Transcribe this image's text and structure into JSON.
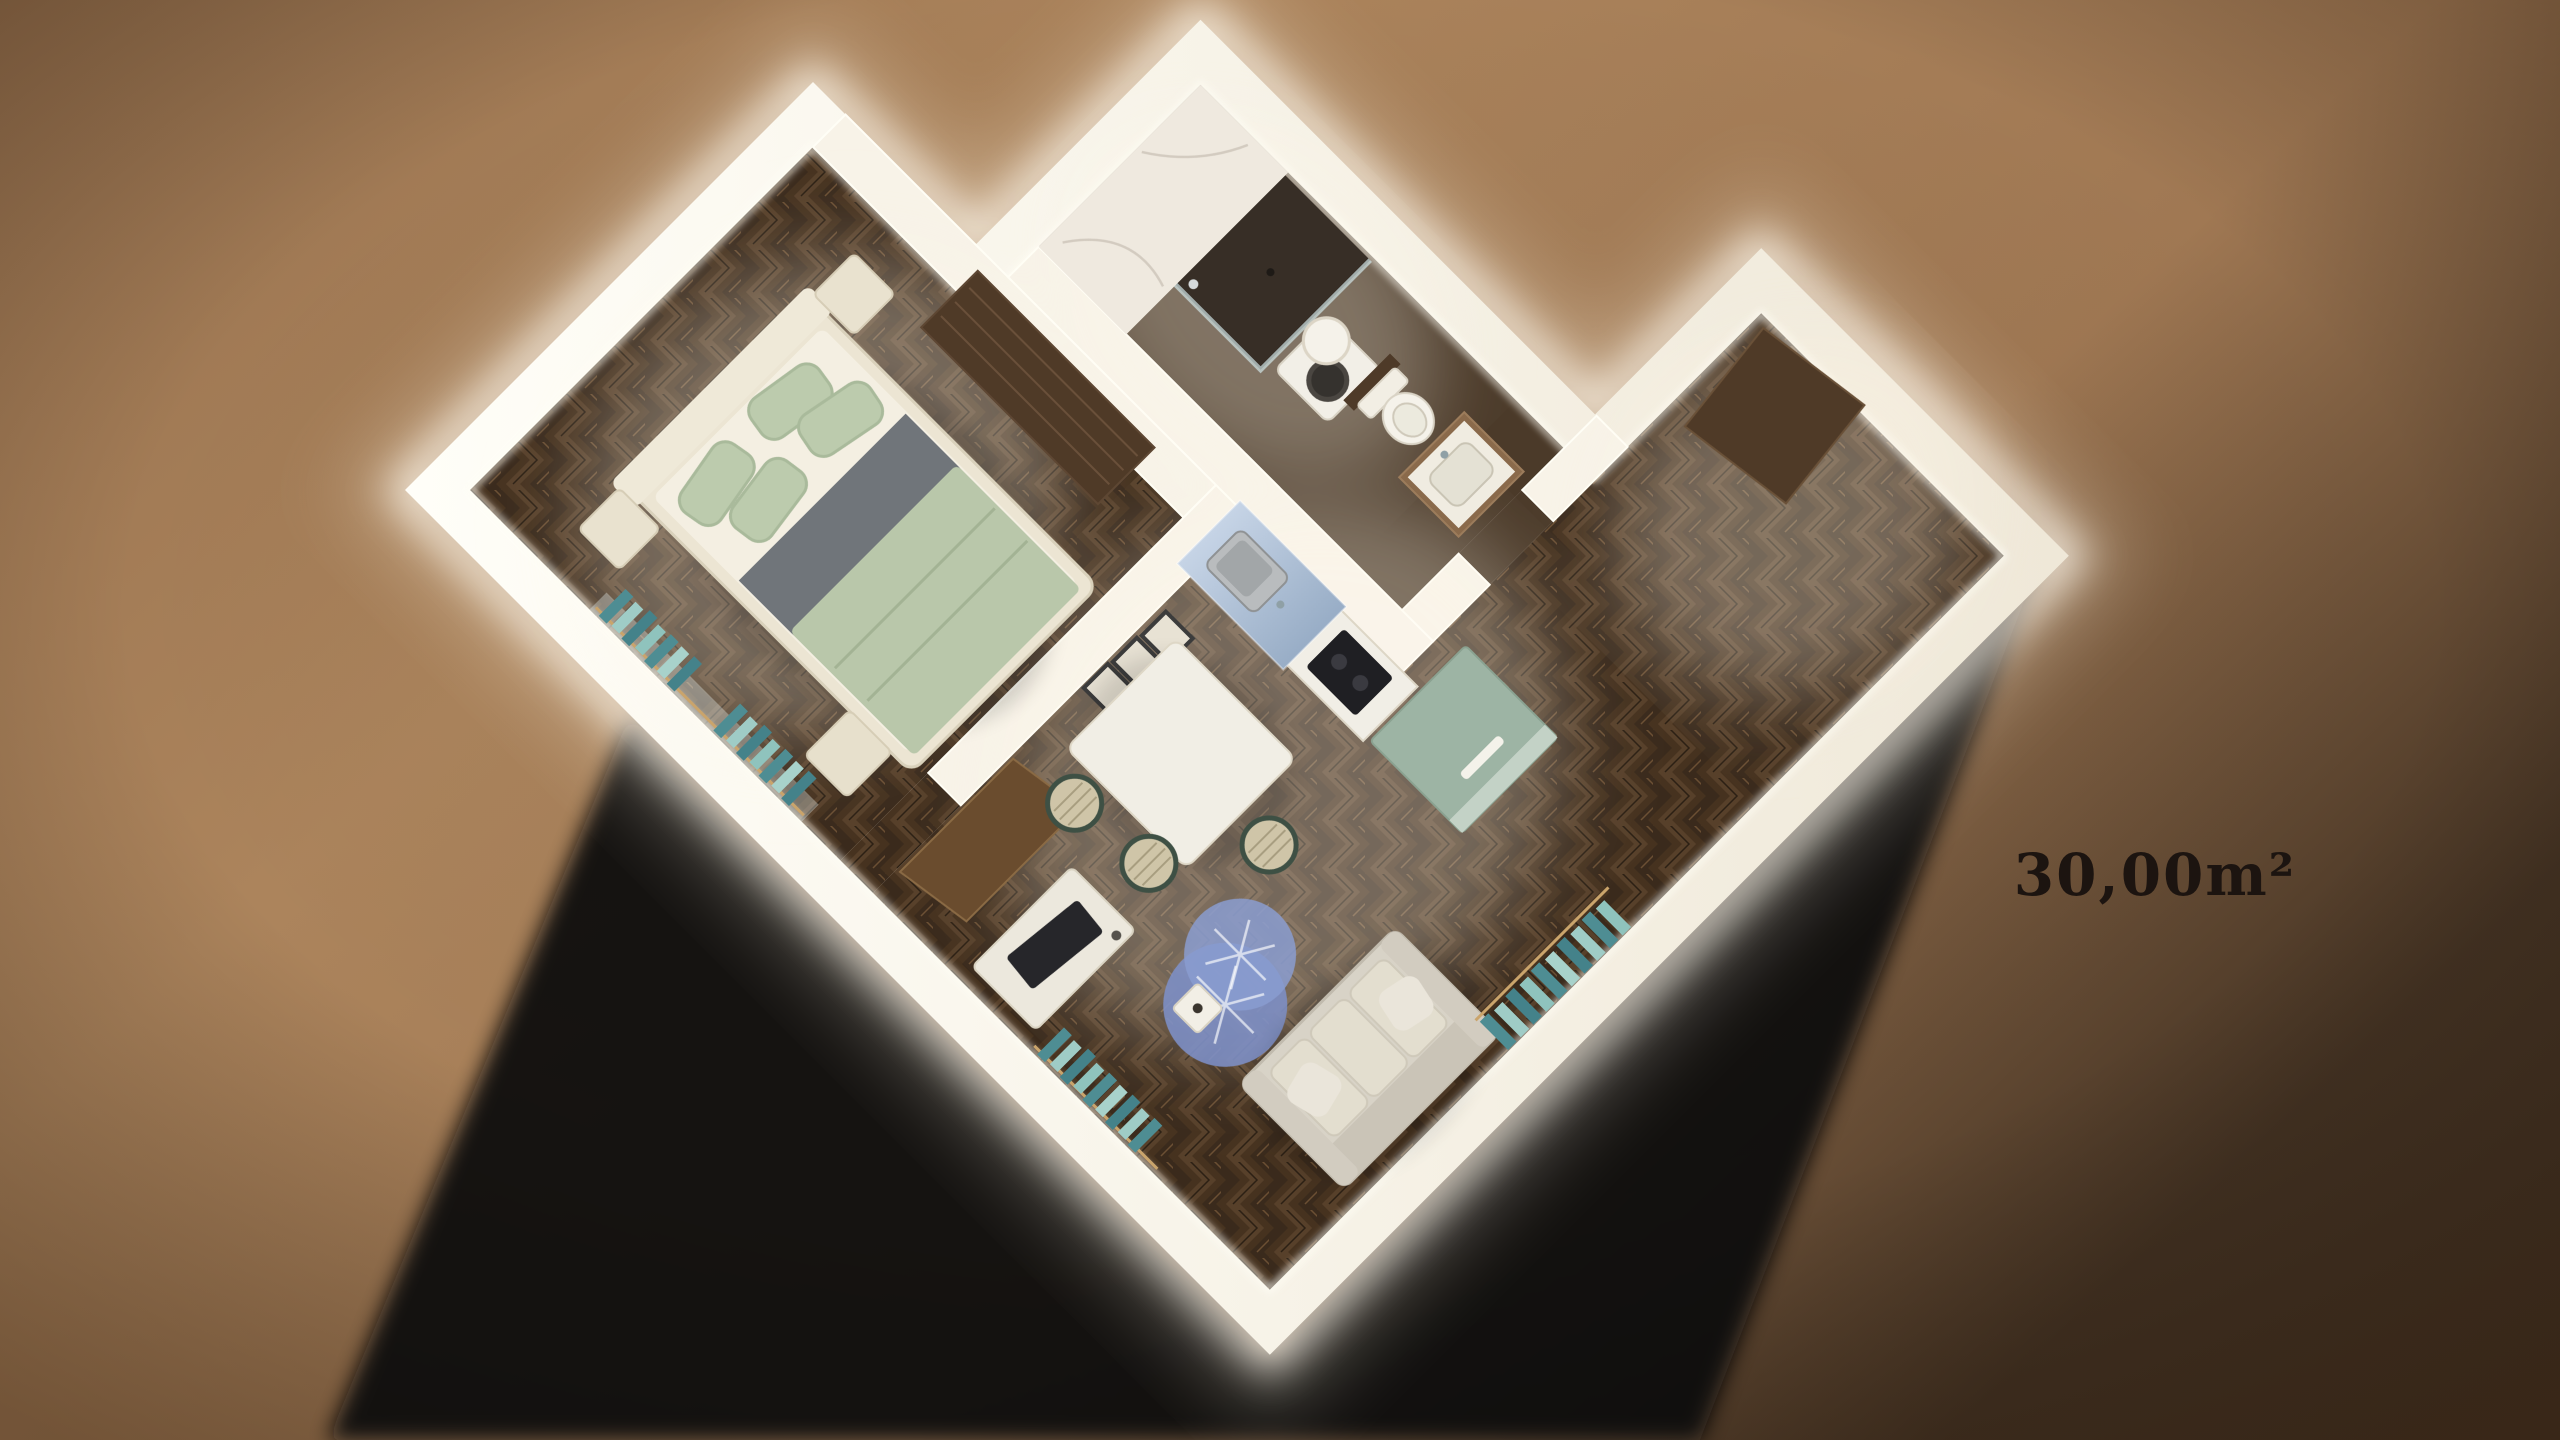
{
  "page": {
    "title": "3D apartment floor plan render"
  },
  "label": {
    "area": "30,00m²"
  },
  "colors": {
    "background_light": "#b0885f",
    "background_dark": "#8a6747",
    "shadow": "#0a0a11",
    "wall": "#f8f3e8",
    "wall_glow": "#fffdf2",
    "floor_wood": "#46321f",
    "floor_bath": "#4b3a29",
    "marble": "#efe9df",
    "teal_curtain": "#4e8d93",
    "sage_bedding": "#b9c7aa",
    "gray_sheet": "#70757a",
    "rug_blue": "#7d90c7",
    "counter_glass_blue": "#b6c6da",
    "cabinet_green": "#9db4a4",
    "wood_dark": "#4f3a27",
    "sofa_gray": "#d8d3c7",
    "text": "#1c1410"
  },
  "scene": {
    "view": "isometric-top-down-render",
    "rooms": [
      {
        "name": "bedroom",
        "furniture": [
          "double-bed",
          "sage-pillows",
          "nightstand",
          "nightstand",
          "foot-ottoman",
          "dark-wardrobe",
          "teal-curtains"
        ]
      },
      {
        "name": "bathroom",
        "furniture": [
          "walk-in-shower",
          "washing-machine",
          "water-heater-cylinder",
          "toilet",
          "wood-vanity",
          "marble-wall"
        ]
      },
      {
        "name": "living-kitchen",
        "furniture": [
          "kitchen-counter",
          "sink",
          "cooktop",
          "blue-glass-panel",
          "green-cabinet",
          "dining-table",
          "woven-stool",
          "woven-stool",
          "woven-stool",
          "wall-art-frames",
          "open-door",
          "tv-cabinet",
          "round-blue-rugs",
          "side-table",
          "sofa",
          "teal-curtains"
        ]
      },
      {
        "name": "entry-hall",
        "furniture": [
          "dark-entry-panel"
        ]
      }
    ]
  }
}
